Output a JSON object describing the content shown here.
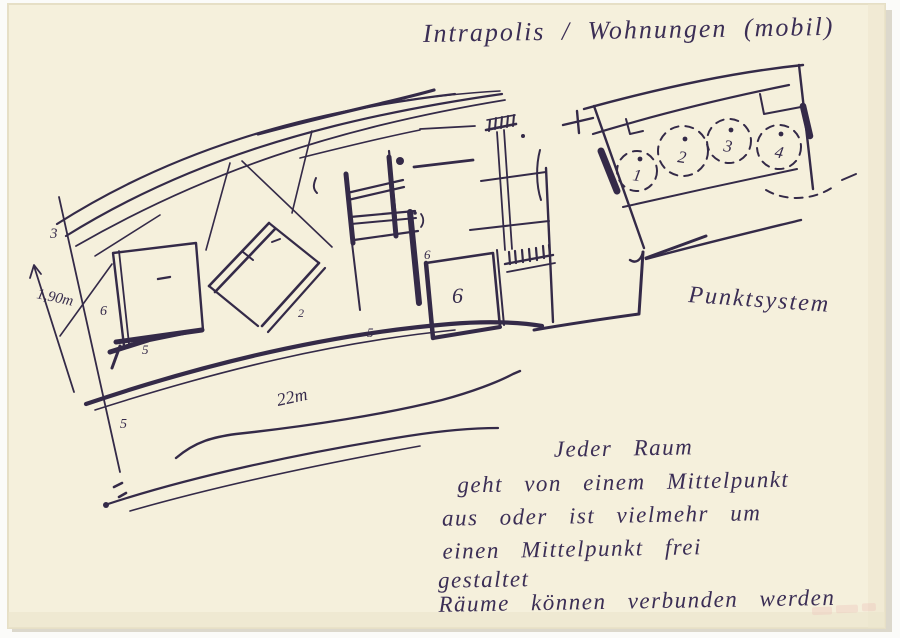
{
  "page": {
    "title": "Intrapolis / Wohnungen (mobil)",
    "system_label": "Punktsystem",
    "dimensions": {
      "band_height": "1,90m",
      "band_length": "22m"
    },
    "plan_numbers": {
      "band_left": "3",
      "room_a_side": "6",
      "room_a_bottom": "5",
      "room_b": "2",
      "room_mid_bottom": "5",
      "room_e_small": "6",
      "room_e_big": "6",
      "below_band": "5"
    },
    "point_numbers": [
      "1",
      "2",
      "3",
      "4"
    ],
    "notes": [
      "Jeder Raum",
      "geht von einem Mittelpunkt",
      "aus oder ist vielmehr um",
      "einen Mittelpunkt frei",
      "gestaltet",
      "Räume können verbunden werden"
    ],
    "colors": {
      "paper": "#f5f0dc",
      "ink": "#342a48",
      "stamp": "#eec6bd"
    }
  }
}
